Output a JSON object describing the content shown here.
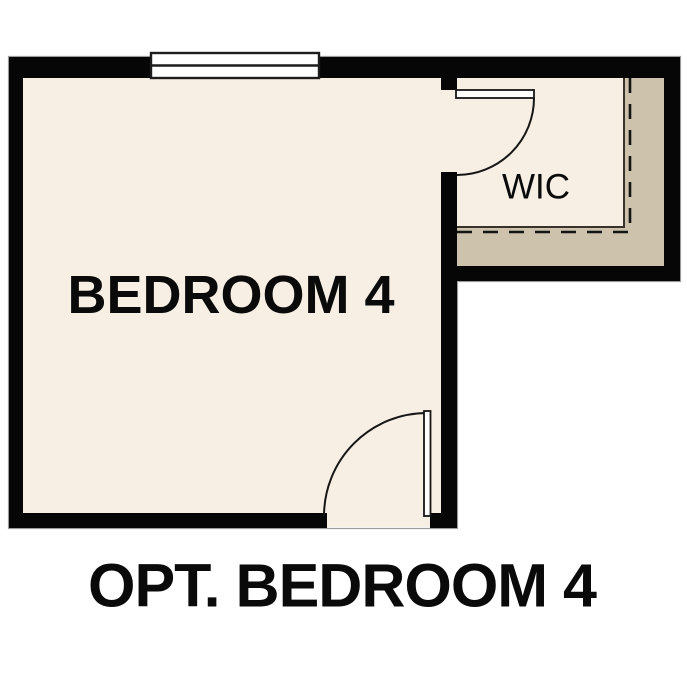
{
  "caption": {
    "text": "OPT. BEDROOM 4"
  },
  "rooms": {
    "bedroom": {
      "label": "BEDROOM 4"
    },
    "closet": {
      "label": "WIC"
    }
  },
  "features": {
    "window": "window",
    "bedroom_door": "door-swing",
    "closet_door": "door-swing",
    "closet_band": "closet-shelf-band"
  },
  "colors": {
    "wall": "#060606",
    "floor": "#f7efe4",
    "band": "#cdc3ad",
    "bg": "#ffffff",
    "thin": "#38322a",
    "dash": "#141414",
    "win": "#1d1d1d",
    "edge": "#9c9c9c",
    "ink": "#0a0a0a"
  }
}
